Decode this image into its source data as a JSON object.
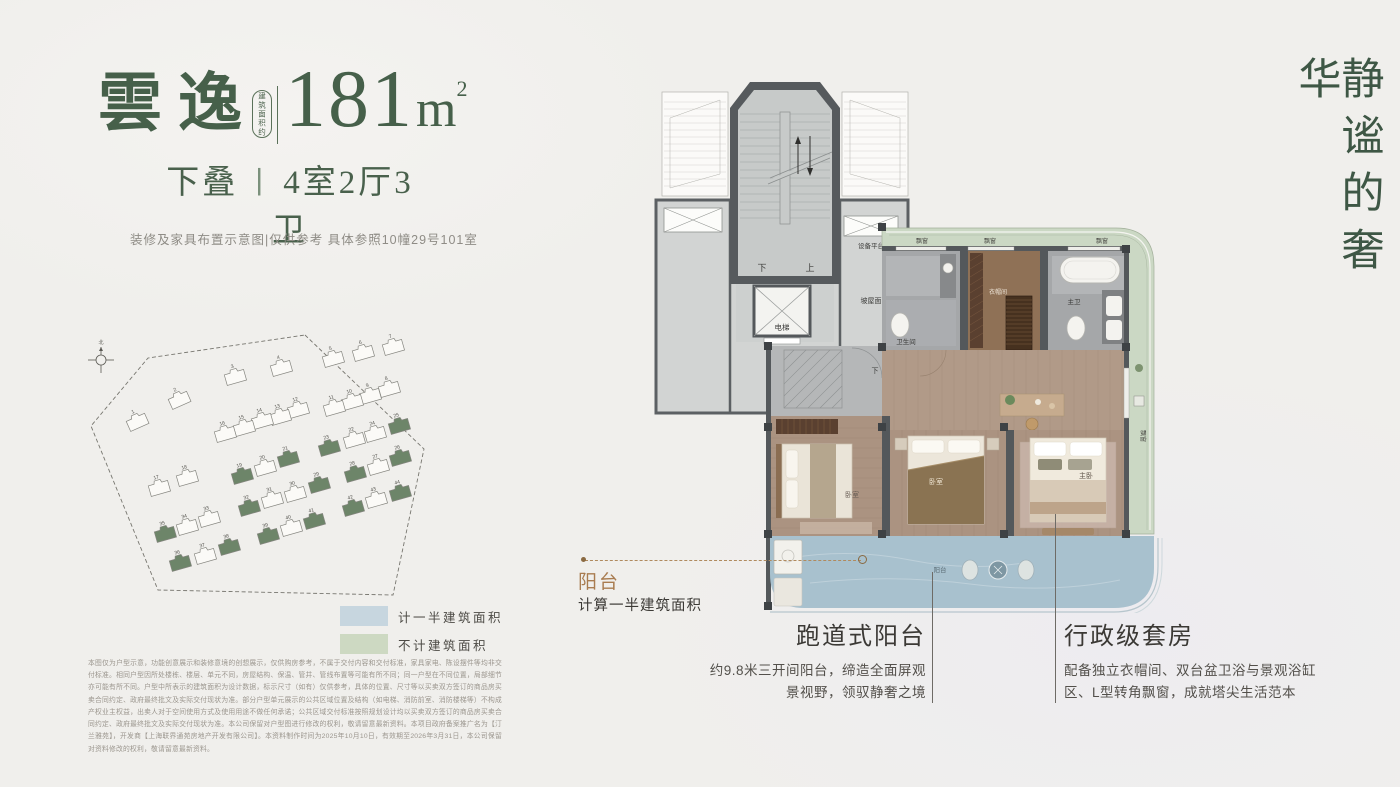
{
  "header": {
    "brand": "雲逸",
    "area_prefix": "建筑面积约",
    "area_number": "181",
    "area_unit": "m",
    "area_sup": "2",
    "type_left": "下叠",
    "type_sep": "丨",
    "type_right": "4室2厅3卫",
    "note": "装修及家具布置示意图|仅供参考 具体参照10幢29号101室"
  },
  "tagline": "静谧的奢华",
  "legend": {
    "items": [
      {
        "label": "计一半建筑面积",
        "color": "#c7d6df"
      },
      {
        "label": "不计建筑面积",
        "color": "#cdd9c2"
      }
    ]
  },
  "colors": {
    "brand_green": "#46604a",
    "gold": "#a97c50",
    "balcony_blue": "#a8c1ce",
    "band_green": "#cbd8c4",
    "building_green": "#6d8569",
    "wall_grey": "#54585b"
  },
  "site_plan": {
    "compass_north": "北",
    "buildings": [
      {
        "n": "1",
        "x": 42,
        "y": 82,
        "g": false,
        "r": -24
      },
      {
        "n": "2",
        "x": 84,
        "y": 60,
        "g": false,
        "r": -24
      },
      {
        "n": "3",
        "x": 140,
        "y": 37,
        "g": false
      },
      {
        "n": "4",
        "x": 186,
        "y": 28,
        "g": false
      },
      {
        "n": "5",
        "x": 238,
        "y": 19,
        "g": false
      },
      {
        "n": "6",
        "x": 268,
        "y": 13,
        "g": false
      },
      {
        "n": "7",
        "x": 298,
        "y": 7,
        "g": false
      },
      {
        "n": "8",
        "x": 294,
        "y": 49,
        "g": false
      },
      {
        "n": "9",
        "x": 275,
        "y": 56,
        "g": false
      },
      {
        "n": "10",
        "x": 257,
        "y": 62,
        "g": false
      },
      {
        "n": "11",
        "x": 239,
        "y": 68,
        "g": false
      },
      {
        "n": "12",
        "x": 203,
        "y": 70,
        "g": false
      },
      {
        "n": "13",
        "x": 185,
        "y": 77,
        "g": false
      },
      {
        "n": "14",
        "x": 167,
        "y": 81,
        "g": false
      },
      {
        "n": "15",
        "x": 149,
        "y": 88,
        "g": false
      },
      {
        "n": "16",
        "x": 130,
        "y": 94,
        "g": false
      },
      {
        "n": "17",
        "x": 64,
        "y": 148,
        "g": false
      },
      {
        "n": "18",
        "x": 92,
        "y": 138,
        "g": false
      },
      {
        "n": "19",
        "x": 147,
        "y": 136,
        "g": true
      },
      {
        "n": "20",
        "x": 170,
        "y": 128,
        "g": false
      },
      {
        "n": "21",
        "x": 193,
        "y": 119,
        "g": true
      },
      {
        "n": "22",
        "x": 259,
        "y": 100,
        "g": false
      },
      {
        "n": "23",
        "x": 234,
        "y": 108,
        "g": true
      },
      {
        "n": "24",
        "x": 280,
        "y": 94,
        "g": false
      },
      {
        "n": "25",
        "x": 304,
        "y": 86,
        "g": true
      },
      {
        "n": "26",
        "x": 305,
        "y": 118,
        "g": true
      },
      {
        "n": "27",
        "x": 283,
        "y": 127,
        "g": false
      },
      {
        "n": "28",
        "x": 260,
        "y": 134,
        "g": true
      },
      {
        "n": "29",
        "x": 224,
        "y": 145,
        "g": true
      },
      {
        "n": "30",
        "x": 200,
        "y": 154,
        "g": false
      },
      {
        "n": "31",
        "x": 177,
        "y": 160,
        "g": false
      },
      {
        "n": "32",
        "x": 154,
        "y": 168,
        "g": true
      },
      {
        "n": "33",
        "x": 114,
        "y": 179,
        "g": false
      },
      {
        "n": "34",
        "x": 92,
        "y": 187,
        "g": false
      },
      {
        "n": "35",
        "x": 70,
        "y": 194,
        "g": true
      },
      {
        "n": "36",
        "x": 85,
        "y": 223,
        "g": true
      },
      {
        "n": "37",
        "x": 110,
        "y": 216,
        "g": false
      },
      {
        "n": "38",
        "x": 134,
        "y": 207,
        "g": true
      },
      {
        "n": "39",
        "x": 173,
        "y": 196,
        "g": true
      },
      {
        "n": "40",
        "x": 196,
        "y": 188,
        "g": false
      },
      {
        "n": "41",
        "x": 219,
        "y": 181,
        "g": true
      },
      {
        "n": "42",
        "x": 258,
        "y": 168,
        "g": true
      },
      {
        "n": "43",
        "x": 281,
        "y": 160,
        "g": false
      },
      {
        "n": "44",
        "x": 305,
        "y": 153,
        "g": true
      }
    ]
  },
  "plan": {
    "labels": {
      "down": "下",
      "up": "上",
      "equip": "设备平台",
      "elevator": "电梯",
      "slope_roof": "坡屋面",
      "bay": "飘窗",
      "bath": "卫生间",
      "cloak": "衣帽间",
      "master_bath": "主卫",
      "bedroom": "卧室",
      "master_bed": "主卧",
      "balcony": "阳台"
    }
  },
  "annotations": {
    "balcony": {
      "title": "阳台",
      "subtitle": "计算一半建筑面积"
    },
    "features": [
      {
        "title": "跑道式阳台",
        "line1": "约9.8米三开间阳台，缔造全面屏观",
        "line2": "景视野，领驭静奢之境"
      },
      {
        "title": "行政级套房",
        "line1": "配备独立衣帽间、双台盆卫浴与景观浴缸",
        "line2": "区、L型转角飘窗，成就塔尖生活范本"
      }
    ]
  },
  "disclaimer": "本图仅为户型示意，功能创意展示和装修意境的创想展示，仅供购房参考，不属于交付内容和交付标准，家具家电、陈设摆件等均非交付标准。相同户型因所处楼栋、楼层、单元不同，房屋结构、保温、管井、管线布置等可能有所不同；同一户型在不同位置，局部细节亦可能有所不同。户型中所表示的建筑面积为设计数据，标示尺寸（如有）仅供参考，具体的位置、尺寸等以买卖双方签订的商品房买卖合同约定、政府最终批文及实际交付现状为准。部分户型单元展示的公共区域位置及结构（如电梯、消防前室、消防楼梯等）不构成产权业主权益，出卖人对于空间使用方式及使用用途不做任何承诺；公共区域交付标准按照规划设计均以买卖双方签订的商品房买卖合同约定、政府最终批文及实际交付现状为准。本公司保留对户型图进行修改的权利，敬请留意最新资料。本项目政府备案推广名为【汀兰雅苑】，开发商【上海联界通苑房地产开发有限公司】。本资料制作时间为2025年10月10日，有效期至2026年3月31日，本公司保留对资料修改的权利，敬请留意最新资料。"
}
